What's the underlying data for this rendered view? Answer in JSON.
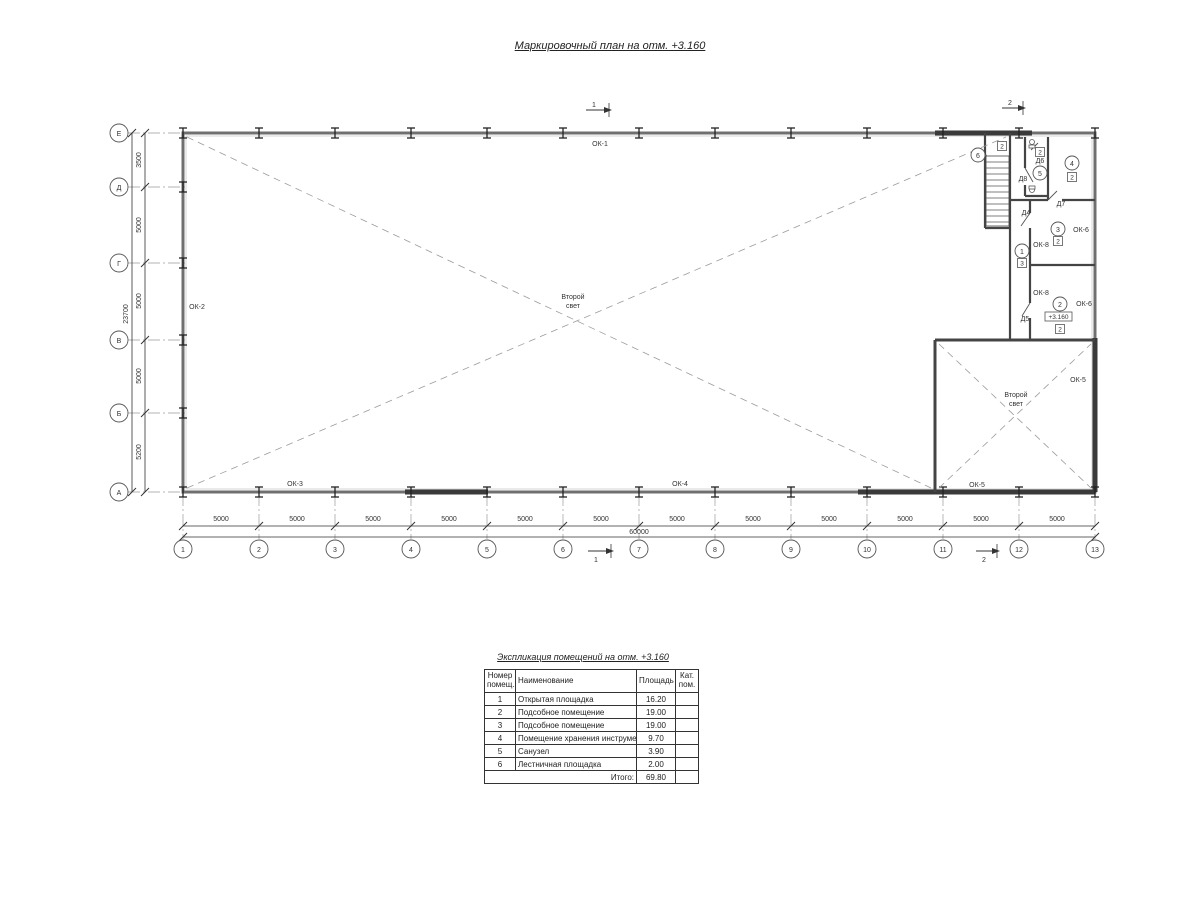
{
  "title": "Маркировочный план на отм. +3.160",
  "plan": {
    "axes_cols": [
      "1",
      "2",
      "3",
      "4",
      "5",
      "6",
      "7",
      "8",
      "9",
      "10",
      "11",
      "12",
      "13"
    ],
    "axes_rows": [
      "Е",
      "Д",
      "Г",
      "В",
      "Б",
      "А"
    ],
    "dims_bottom": [
      "5000",
      "5000",
      "5000",
      "5000",
      "5000",
      "5000",
      "5000",
      "5000",
      "5000",
      "5000",
      "5000",
      "5000"
    ],
    "dim_total_bottom": "60000",
    "dims_left": [
      "3500",
      "5000",
      "5000",
      "5000",
      "5200"
    ],
    "dim_total_left": "23700",
    "labels": {
      "ok1": "ОК-1",
      "ok2": "ОК-2",
      "ok3": "ОК-3",
      "ok4": "ОК-4",
      "ok5a": "ОК-5",
      "ok5b": "ОК-5",
      "ok6a": "ОК-6",
      "ok6b": "ОК-6",
      "ok8a": "ОК-8",
      "ok8b": "ОК-8",
      "d4": "Д4",
      "d5": "Д5",
      "d6": "Д6",
      "d7": "Д7",
      "d8": "Д8",
      "second_light_1": "Второй",
      "second_light_2": "свет",
      "level_mark": "+3.160",
      "section_1": "1",
      "section_2": "2"
    },
    "rooms": {
      "r1": "1",
      "r2": "2",
      "r3": "3",
      "r4": "4",
      "r5": "5",
      "r6": "6"
    },
    "cats": {
      "stair": "2",
      "wc": "2",
      "r4": "2",
      "r3": "2",
      "r1": "3",
      "r2": "2"
    }
  },
  "table": {
    "title": "Экспликация помещений на отм. +3.160",
    "headers": [
      "Номер помещ.",
      "Наименование",
      "Площадь",
      "Кат. пом."
    ],
    "rows": [
      [
        "1",
        "Открытая площадка",
        "16.20",
        ""
      ],
      [
        "2",
        "Подсобное помещение",
        "19.00",
        ""
      ],
      [
        "3",
        "Подсобное помещение",
        "19.00",
        ""
      ],
      [
        "4",
        "Помещение хранения инструмента",
        "9.70",
        ""
      ],
      [
        "5",
        "Санузел",
        "3.90",
        ""
      ],
      [
        "6",
        "Лестничная площадка",
        "2.00",
        ""
      ]
    ],
    "total_label": "Итого:",
    "total_value": "69.80"
  }
}
